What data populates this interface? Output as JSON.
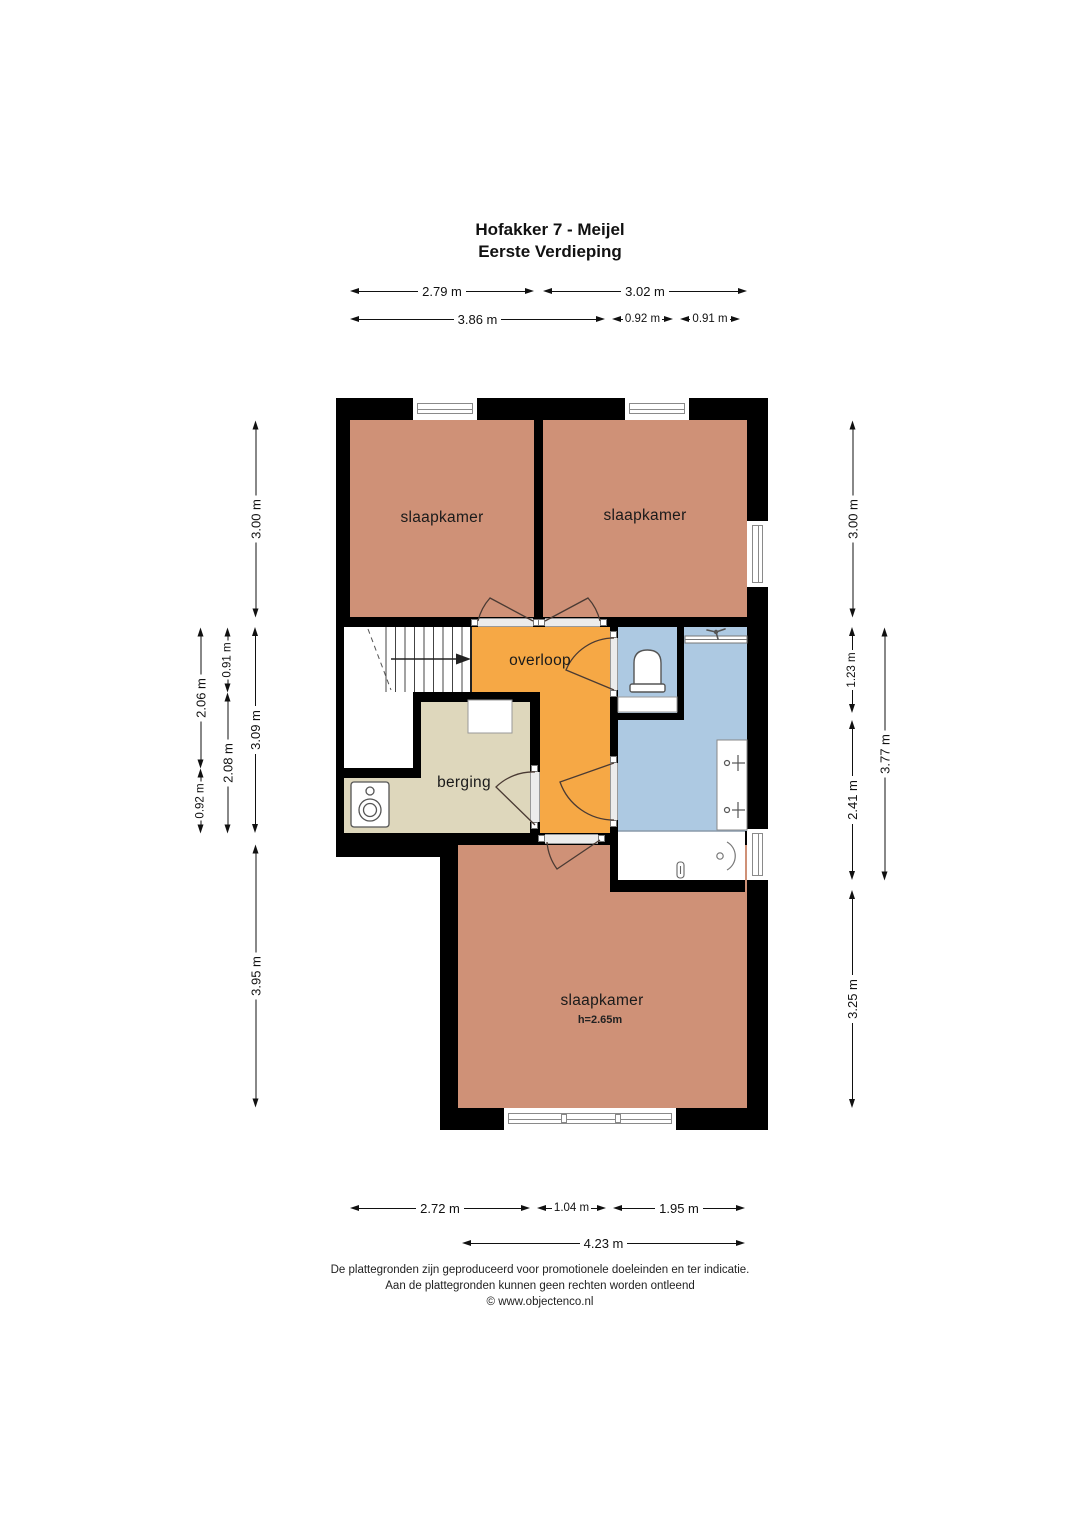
{
  "title": {
    "line1": "Hofakker 7 - Meijel",
    "line2": "Eerste Verdieping"
  },
  "rooms": {
    "bedroom_top_left": {
      "label": "slaapkamer"
    },
    "bedroom_top_right": {
      "label": "slaapkamer"
    },
    "bedroom_bottom": {
      "label": "slaapkamer",
      "height_note": "h=2.65m"
    },
    "landing": {
      "label": "overloop"
    },
    "storage": {
      "label": "berging"
    }
  },
  "dimensions": {
    "top_row_1": [
      "2.79 m",
      "3.02 m"
    ],
    "top_row_2": [
      "3.86 m",
      "0.92 m",
      "0.91 m"
    ],
    "bottom_row_1": [
      "2.72 m",
      "1.04 m",
      "1.95 m"
    ],
    "bottom_row_2": [
      "4.23 m"
    ],
    "left_col_outer": [
      "2.06 m",
      "0.92 m"
    ],
    "left_col_mid": [
      "0.91 m",
      "2.08 m"
    ],
    "left_col_inner": [
      "3.00 m",
      "3.09 m",
      "3.95 m"
    ],
    "right_col_inner": [
      "3.00 m",
      "1.23 m",
      "2.41 m",
      "3.25 m"
    ],
    "right_col_outer": [
      "3.77 m"
    ]
  },
  "footer": {
    "line1": "De plattegronden zijn geproduceerd voor promotionele doeleinden en ter indicatie.",
    "line2": "Aan de plattegronden kunnen geen rechten worden ontleend",
    "line3": "© www.objectenco.nl"
  },
  "colors": {
    "wall": "#000000",
    "bedroom": "#cf9177",
    "landing": "#f6a845",
    "storage": "#ded7bc",
    "bathroom": "#adc9e2",
    "floor_white": "#ffffff"
  }
}
